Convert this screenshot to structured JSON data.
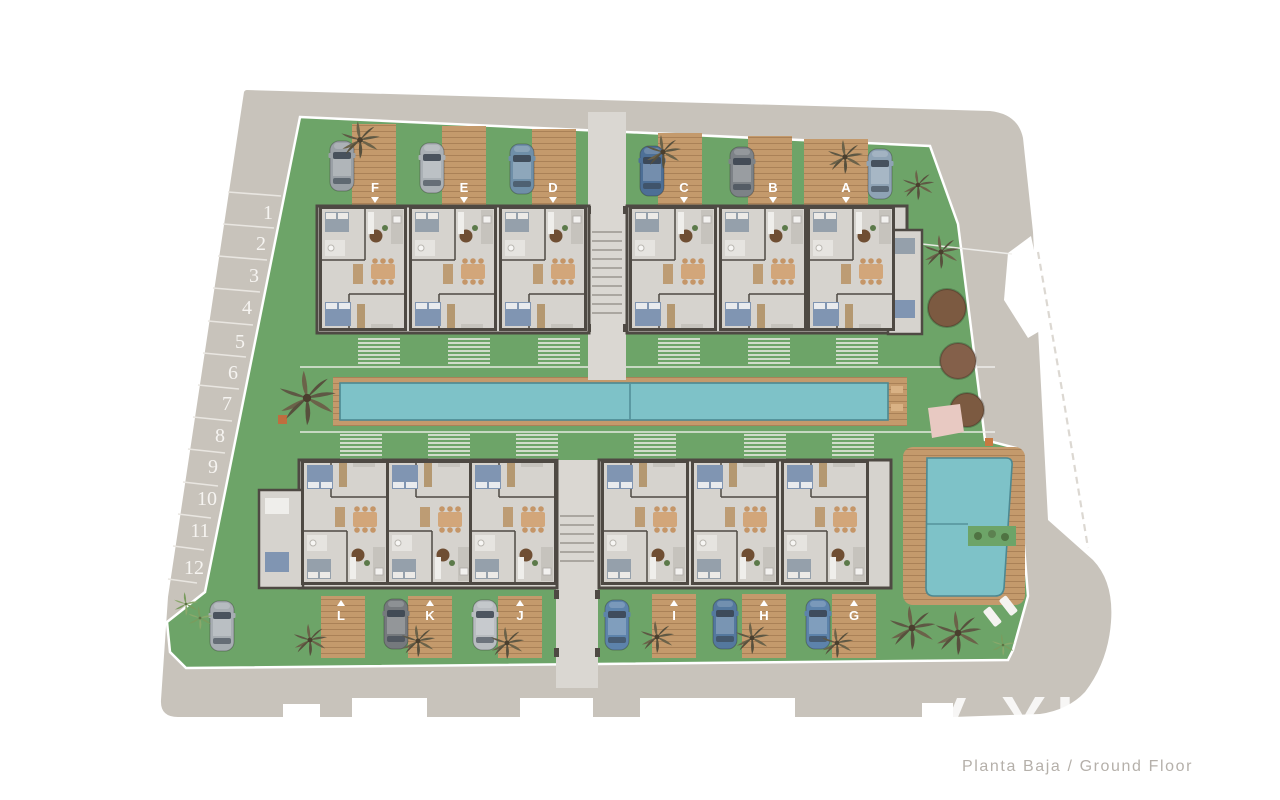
{
  "caption": {
    "text": "Planta Baja / Ground Floor"
  },
  "watermark": {
    "text": "VI"
  },
  "parking": {
    "stalls": [
      "1",
      "2",
      "3",
      "4",
      "5",
      "6",
      "7",
      "8",
      "9",
      "10",
      "11",
      "12"
    ]
  },
  "units": {
    "top": [
      "F",
      "E",
      "D",
      "C",
      "B",
      "A"
    ],
    "bottom": [
      "L",
      "K",
      "J",
      "I",
      "H",
      "G"
    ]
  },
  "site_features": [
    "lap-pool",
    "plunge-pool",
    "gardens",
    "street-parking",
    "wood-deck-driveways",
    "palm-trees",
    "sun-loungers"
  ],
  "colors": {
    "road": "#c8c3bb",
    "grass": "#6da468",
    "water": "#7ec2c8",
    "water_edge": "#4d8891",
    "deck_wood": "#c49a6c",
    "deck_plank": "#aa8157",
    "building_wall": "#4e4943",
    "building_floor": "#d6d3ce",
    "walkway": "#dad7d2",
    "boundary_line": "#ffffff",
    "tree_canopy": "#7c5a41",
    "label_text": "#ffffff",
    "caption_text": "#b5b0aa"
  }
}
